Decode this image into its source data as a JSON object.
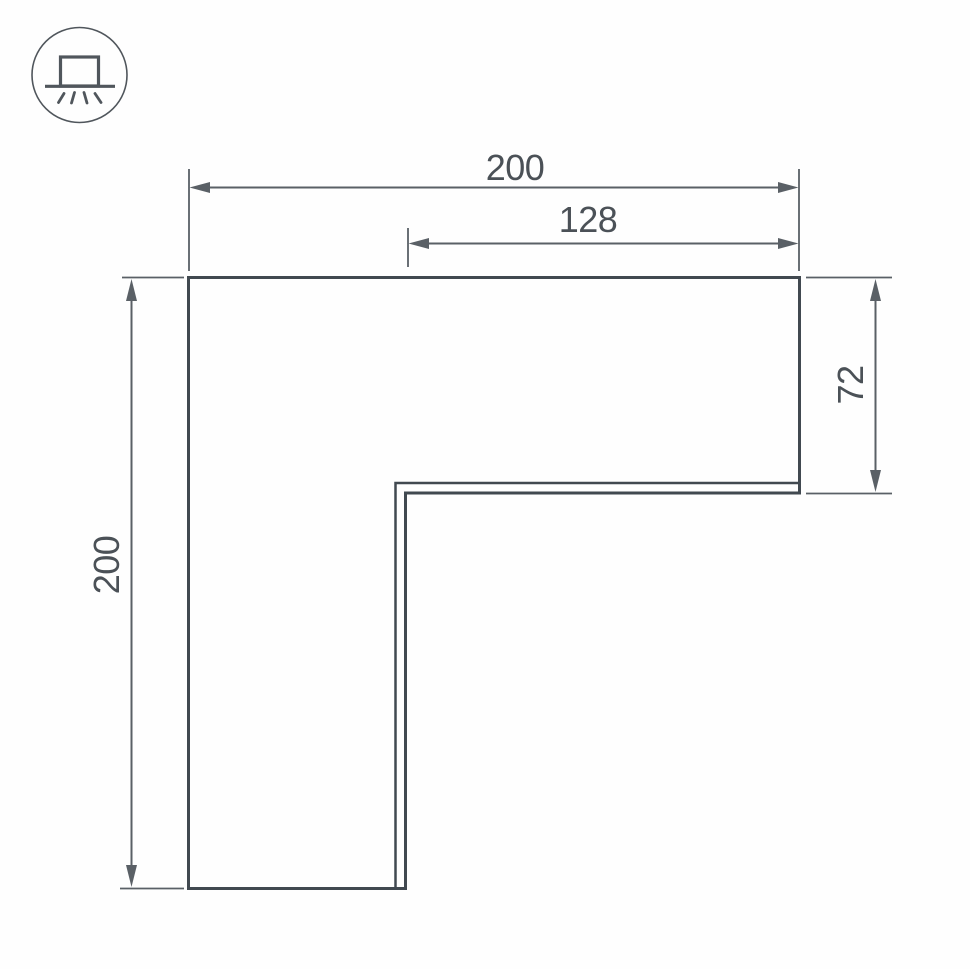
{
  "icons": {
    "mount_type": "surface-mounted-light-icon"
  },
  "drawing": {
    "dimensions": {
      "top_width": "200",
      "top_inner_width": "128",
      "right_height": "72",
      "left_height": "200"
    },
    "colors": {
      "outline": "#414950",
      "dimension": "#5a6066",
      "text": "#4b5157",
      "icon": "#50565c",
      "background": "#fefefe"
    }
  }
}
